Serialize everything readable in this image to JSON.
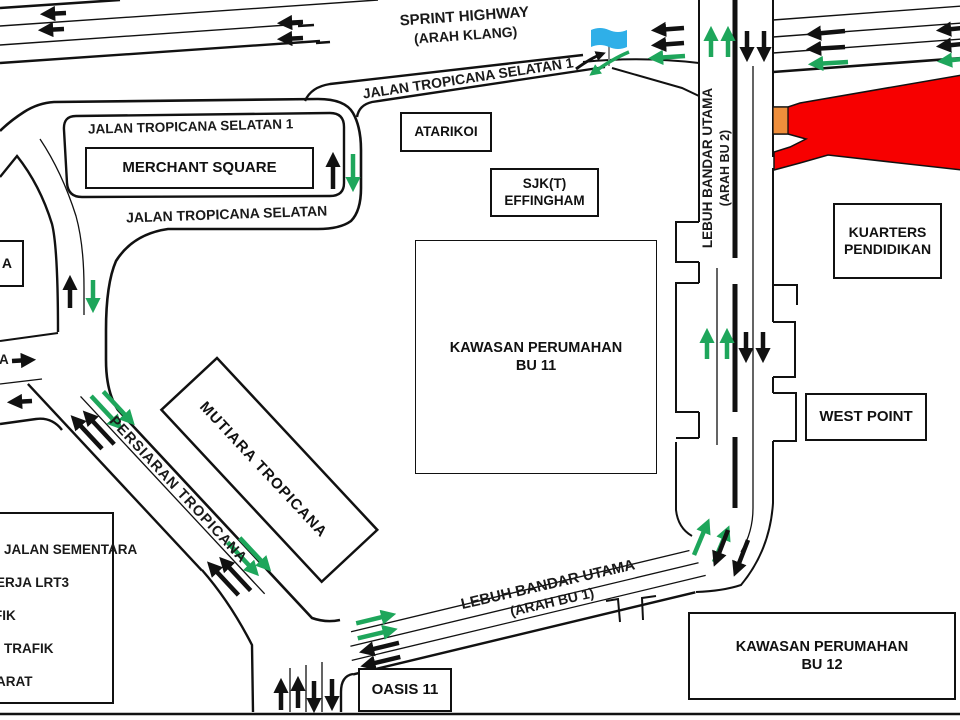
{
  "colors": {
    "arrow_green": "#1EA65B",
    "closure_red": "#F70000",
    "closure_orange": "#EF8E3B",
    "flag_blue": "#2FAFE8",
    "line_black": "#111111"
  },
  "roads": {
    "sprint_highway": [
      "SPRINT HIGHWAY",
      "(ARAH KLANG)"
    ],
    "jalan_ts1_diag": "JALAN TROPICANA SELATAN 1",
    "jalan_ts1_horiz": "JALAN TROPICANA SELATAN 1",
    "jalan_ts": "JALAN TROPICANA SELATAN",
    "lebuh_bandar_utama_2": [
      "LEBUH BANDAR UTAMA",
      "(ARAH BU 2)"
    ],
    "persiaran_tropicana": "PERSIARAN TROPICANA",
    "lebuh_bandar_utama_1": [
      "LEBUH BANDAR UTAMA",
      "(ARAH BU 1)"
    ]
  },
  "places": {
    "merchant_square": "MERCHANT SQUARE",
    "atarikoi": "ATARIKOI",
    "sjkt_effingham": [
      "SJK(T)",
      "EFFINGHAM"
    ],
    "kuarters_pendidikan": [
      "KUARTERS",
      "PENDIDIKAN"
    ],
    "kawasan_bu11": [
      "KAWASAN PERUMAHAN",
      "BU 11"
    ],
    "west_point": "WEST POINT",
    "mutiara_tropicana": "MUTIARA TROPICANA",
    "oasis_11": "OASIS 11",
    "kawasan_bu12": [
      "KAWASAN PERUMAHAN",
      "BU 12"
    ],
    "edge_label_top": "A",
    "edge_label_mid": "A"
  },
  "legend": {
    "items": [
      "JALAN SEMENTARA",
      "ERJA LRT3",
      "FIK",
      "TRAFIK",
      "ARAT"
    ]
  }
}
